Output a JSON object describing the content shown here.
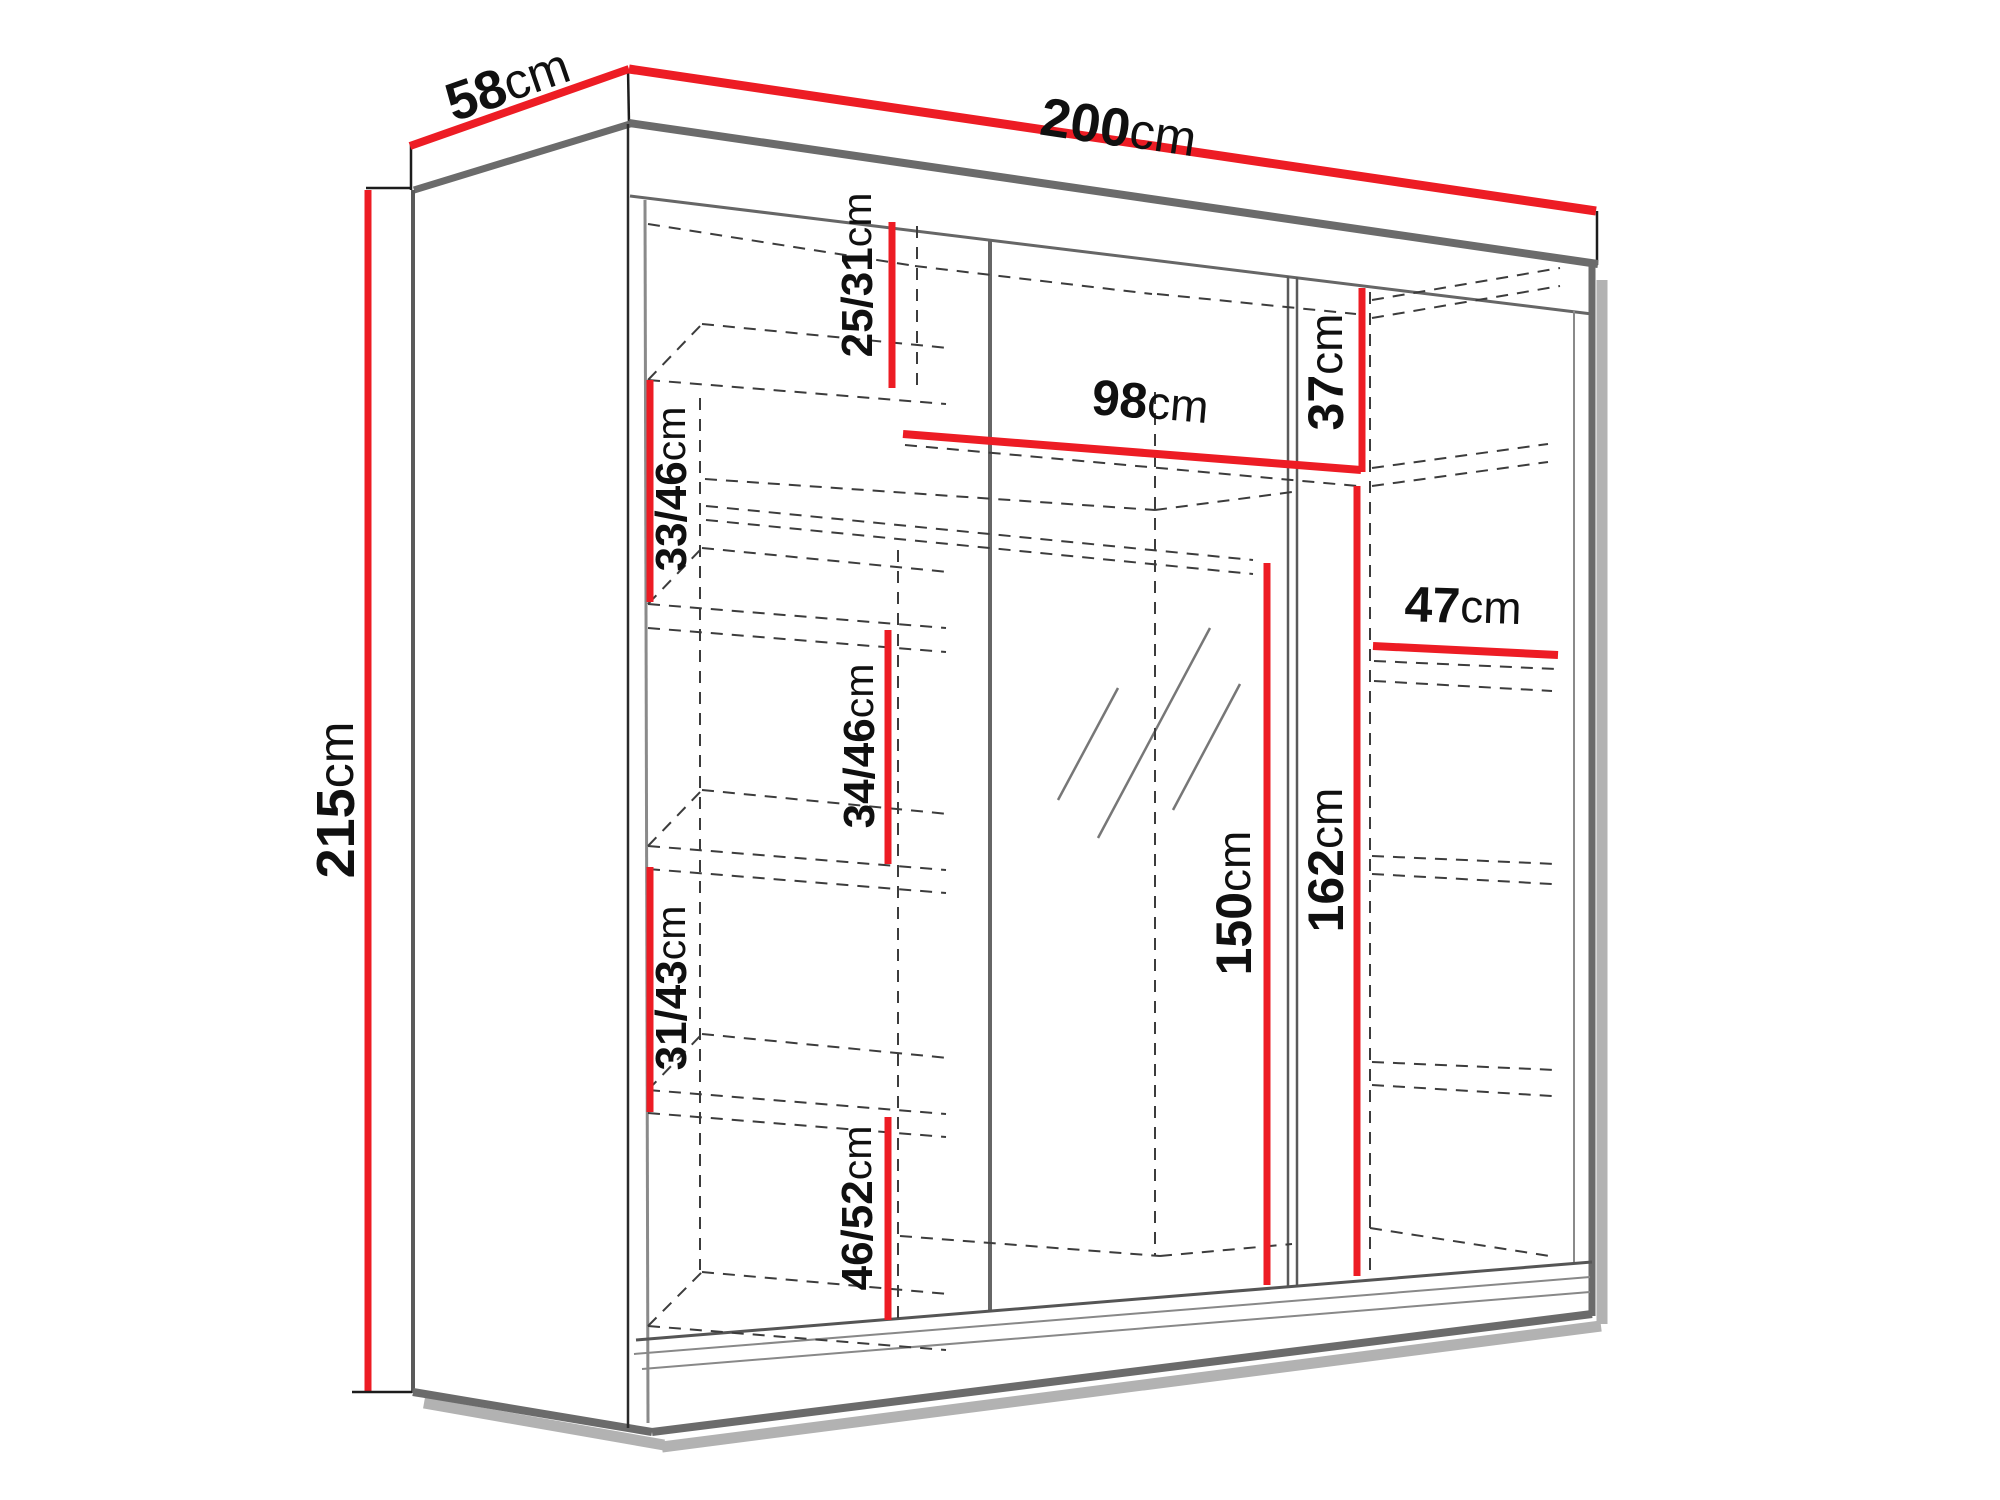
{
  "diagram": {
    "type": "furniture-dimension-diagram",
    "subject": "three-door sliding wardrobe with mirror, technical drawing with measurements",
    "unit": "cm",
    "accent_color": "#ed1c24",
    "line_color": "#6b6b6b",
    "dimensions": [
      {
        "id": "depth-top",
        "num": "58",
        "unit": "cm",
        "orientation": "slanted-top-left"
      },
      {
        "id": "width-top",
        "num": "200",
        "unit": "cm",
        "orientation": "slanted-top-right"
      },
      {
        "id": "height-left",
        "num": "215",
        "unit": "cm",
        "orientation": "vertical-left"
      },
      {
        "id": "top-compartment",
        "num": "25/31",
        "unit": "cm",
        "orientation": "vertical-interior"
      },
      {
        "id": "top-shelf-width",
        "num": "98",
        "unit": "cm",
        "orientation": "horizontal-interior"
      },
      {
        "id": "right-top-compartment",
        "num": "37",
        "unit": "cm",
        "orientation": "vertical-interior"
      },
      {
        "id": "left-shelf-1",
        "num": "33/46",
        "unit": "cm",
        "orientation": "vertical-interior"
      },
      {
        "id": "left-shelf-2",
        "num": "34/46",
        "unit": "cm",
        "orientation": "vertical-interior"
      },
      {
        "id": "right-shelf-width",
        "num": "47",
        "unit": "cm",
        "orientation": "horizontal-interior"
      },
      {
        "id": "left-shelf-3",
        "num": "31/43",
        "unit": "cm",
        "orientation": "vertical-interior"
      },
      {
        "id": "mirror-height",
        "num": "150",
        "unit": "cm",
        "orientation": "vertical-interior"
      },
      {
        "id": "hanging-space",
        "num": "162",
        "unit": "cm",
        "orientation": "vertical-interior"
      },
      {
        "id": "left-shelf-4",
        "num": "46/52",
        "unit": "cm",
        "orientation": "vertical-interior"
      }
    ]
  }
}
